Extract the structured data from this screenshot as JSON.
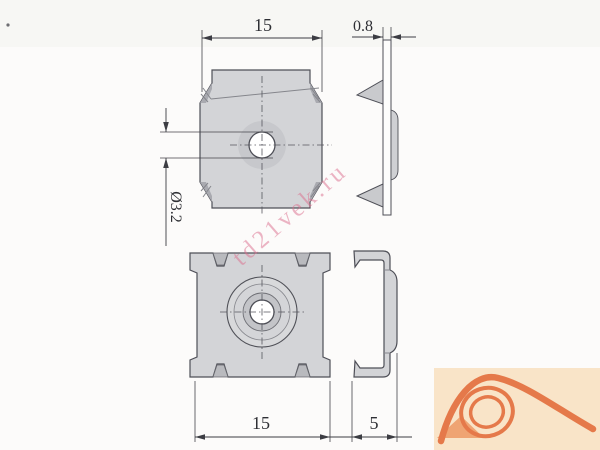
{
  "drawing": {
    "watermark": {
      "text": "td21vek.ru"
    },
    "dimensions": {
      "top_view_width": "15",
      "plate_thickness": "0.8",
      "hole_diameter": "Ø3.2",
      "front_view_width": "15",
      "clip_depth": "5"
    }
  },
  "colors": {
    "bg": "#fcfbfa",
    "part-fill": "#d3d4d7",
    "part-dark": "#b9babe",
    "part-outline": "#4e4f57",
    "dim-color": "#3c3d43",
    "watermark": "#dc6e8d",
    "logo-bg": "#f9e4c8",
    "logo-orange": "#e5794a",
    "logo-triangle": "#efa473"
  }
}
